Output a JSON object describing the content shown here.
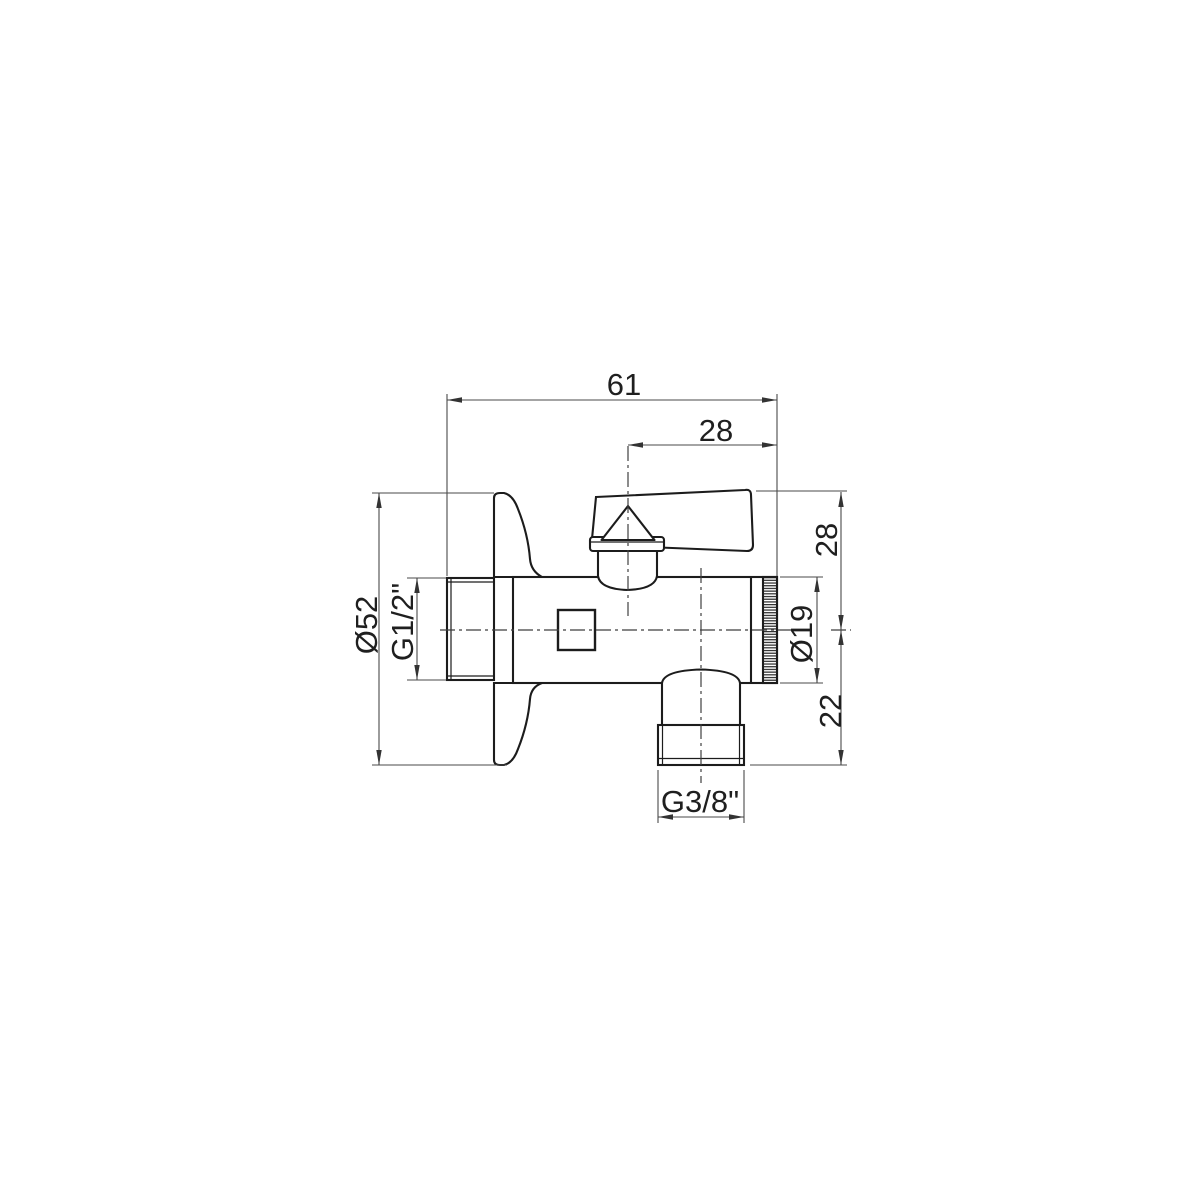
{
  "drawing": {
    "type": "technical-dimension-drawing",
    "subject": "angle valve side view with wall rosette, lever handle and bottom outlet",
    "background_color": "#ffffff",
    "object_line_color": "#1c1c1c",
    "dimension_line_color": "#4a4a4a",
    "text_color": "#1f1f1f",
    "dims": {
      "overall_width": "61",
      "handle_center_to_end": "28",
      "axis_to_handle_top": "28",
      "cap_diameter": "Ø19",
      "axis_to_outlet_end": "22",
      "rosette_diameter": "Ø52",
      "inlet_thread": "G1/2\"",
      "outlet_thread": "G3/8\""
    }
  }
}
